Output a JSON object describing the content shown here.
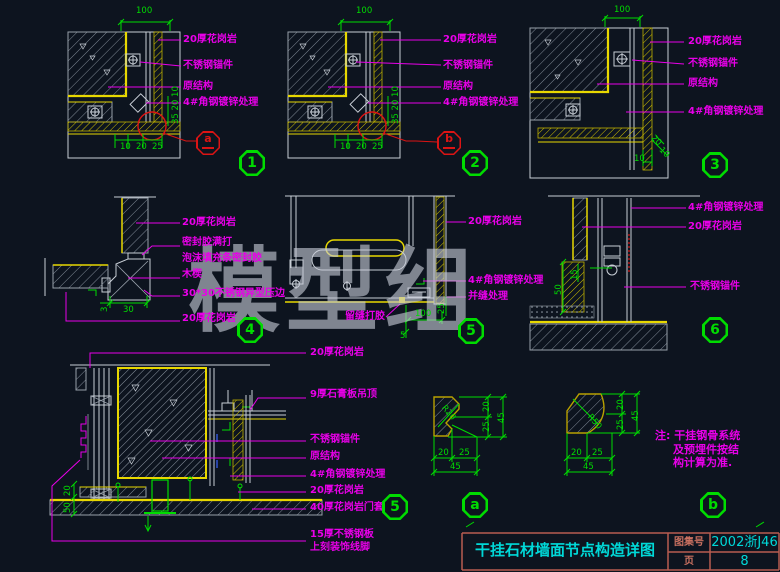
{
  "watermark": "模型组",
  "colors": {
    "background": "#0d141f",
    "line_gray": "#c8ced6",
    "stone_yellow": "#e8d800",
    "dimension_green": "#00dc00",
    "label_magenta": "#e800e8",
    "callout_red": "#dc1414",
    "title_cyan": "#00d8d8",
    "title_border": "#b85c50"
  },
  "note": {
    "lines": [
      "注: 干挂钢骨系统",
      "及预埋件按结",
      "构计算为准."
    ]
  },
  "title_block": {
    "title": "干挂石材墙面节点构造详图",
    "catalog_label": "图集号",
    "catalog_value": "2002浙J46",
    "page_label": "页",
    "page_value": "8"
  },
  "details": {
    "d1": {
      "number": "1",
      "callout": "a",
      "labels": [
        "20厚花岗岩",
        "不锈钢锚件",
        "原结构",
        "4#角钢镀锌处理"
      ],
      "dim_top": "100",
      "dims_bottom": [
        "10",
        "20",
        "25"
      ],
      "dim_side": "35 20 10"
    },
    "d2": {
      "number": "2",
      "callout": "b",
      "labels": [
        "20厚花岗岩",
        "不锈钢锚件",
        "原结构",
        "4#角钢镀锌处理"
      ],
      "dim_top": "100",
      "dims_bottom": [
        "10",
        "20",
        "25"
      ],
      "dim_side": "35 20 10"
    },
    "d3": {
      "number": "3",
      "labels": [
        "20厚花岗岩",
        "不锈钢锚件",
        "原结构",
        "4#角钢镀锌处理"
      ],
      "dim_top": "100",
      "dim_bottom": "10",
      "dims_diag": [
        "20",
        "10"
      ]
    },
    "d4": {
      "number": "4",
      "labels": [
        "20厚花岗岩",
        "密封胶满打",
        "泡沫填充条密封胶",
        "木楔",
        "30*30不锈钢异型压边",
        "20厚花岗岩"
      ],
      "dims": [
        "3",
        "30"
      ]
    },
    "d5": {
      "number": "5",
      "labels_right": [
        "20厚花岗岩",
        "4#角钢镀锌处理",
        "并缝处理"
      ],
      "label_joint": "留缝打胶",
      "dim_h": "100",
      "dim_v": "25",
      "dim_gap": "5"
    },
    "d6": {
      "number": "6",
      "labels": [
        "4#角钢镀锌处理",
        "20厚花岗岩",
        "不锈钢锚件"
      ],
      "dims": [
        "15",
        "50"
      ]
    },
    "d7": {
      "number": "5",
      "labels": [
        "20厚花岗岩",
        "9厚石膏板吊顶",
        "不锈钢锚件",
        "原结构",
        "4#角钢镀锌处理",
        "20厚花岗岩",
        "40厚花岗岩门套",
        "15厚不锈钢板",
        "上刻装饰线脚"
      ],
      "dims": [
        "20",
        "50"
      ]
    },
    "da": {
      "number": "a",
      "radius": "R20",
      "dims_v": [
        "20",
        "25",
        "45"
      ],
      "dims_h": [
        "20",
        "25",
        "45"
      ]
    },
    "db": {
      "number": "b",
      "radius": "R50",
      "dims_v": [
        "20",
        "25",
        "45"
      ],
      "dims_h": [
        "20",
        "25",
        "45"
      ]
    }
  }
}
